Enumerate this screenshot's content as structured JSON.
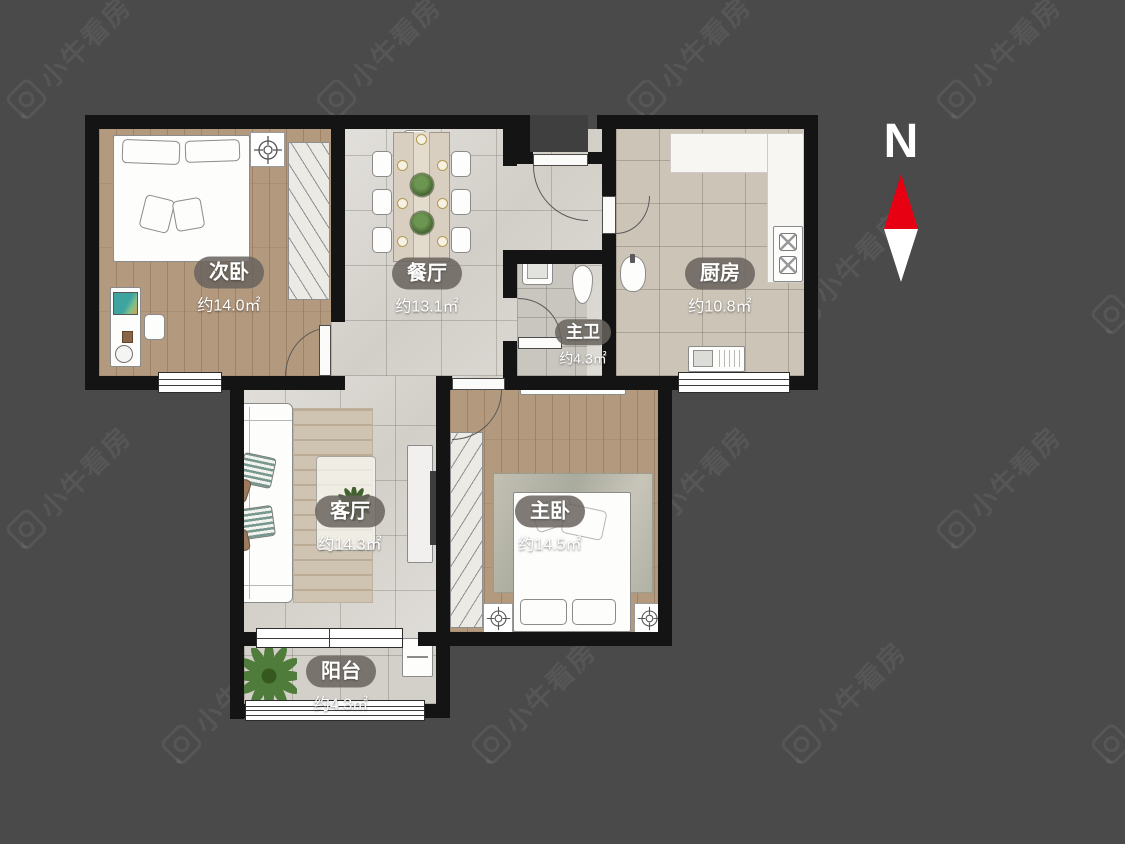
{
  "page": {
    "background": "#4a4a4b"
  },
  "watermark": {
    "text": "小牛看房"
  },
  "compass": {
    "label": "N",
    "up_color": "#e60012",
    "down_color": "#ffffff"
  },
  "rooms": [
    {
      "key": "secondary-bedroom",
      "label": "次卧",
      "area": "约14.0㎡"
    },
    {
      "key": "dining-room",
      "label": "餐厅",
      "area": "约13.1㎡"
    },
    {
      "key": "master-bathroom",
      "label": "主卫",
      "area": "约4.3㎡"
    },
    {
      "key": "kitchen",
      "label": "厨房",
      "area": "约10.8㎡"
    },
    {
      "key": "living-room",
      "label": "客厅",
      "area": "约14.3㎡"
    },
    {
      "key": "master-bedroom",
      "label": "主卧",
      "area": "约14.5㎡"
    },
    {
      "key": "balcony",
      "label": "阳台",
      "area": "约4.3㎡"
    }
  ]
}
